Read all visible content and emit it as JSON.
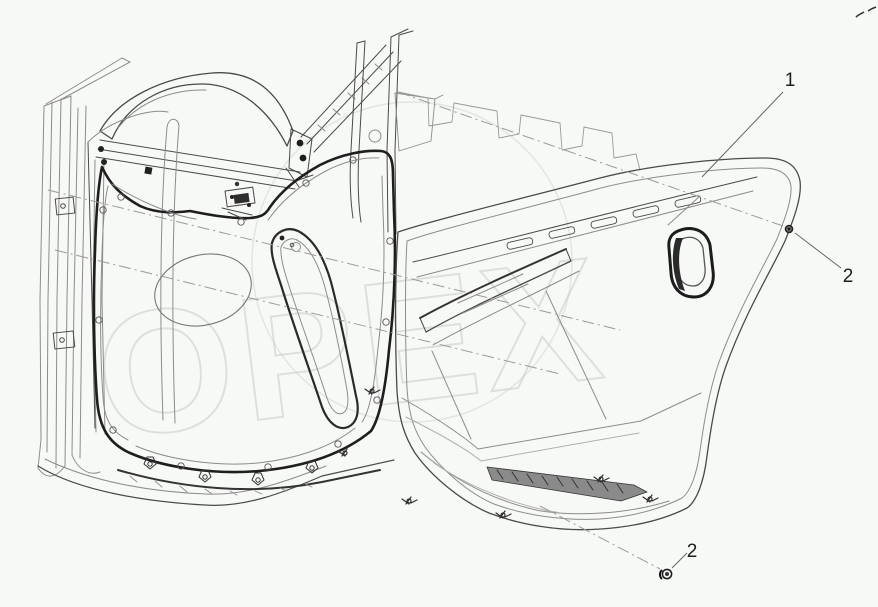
{
  "watermark": {
    "text": "ОРЕХ",
    "color": "#c3c7c3"
  },
  "callouts": [
    {
      "label": "1"
    },
    {
      "label": "2"
    },
    {
      "label": "2"
    }
  ],
  "colors": {
    "background": "#f7f9f6",
    "line_dark": "#1e1e1e",
    "line_medium": "#4a4a4a",
    "line_light": "#8c8c8c",
    "reference_line": "#9a9a9a",
    "callout_text": "#1d1d1d"
  }
}
